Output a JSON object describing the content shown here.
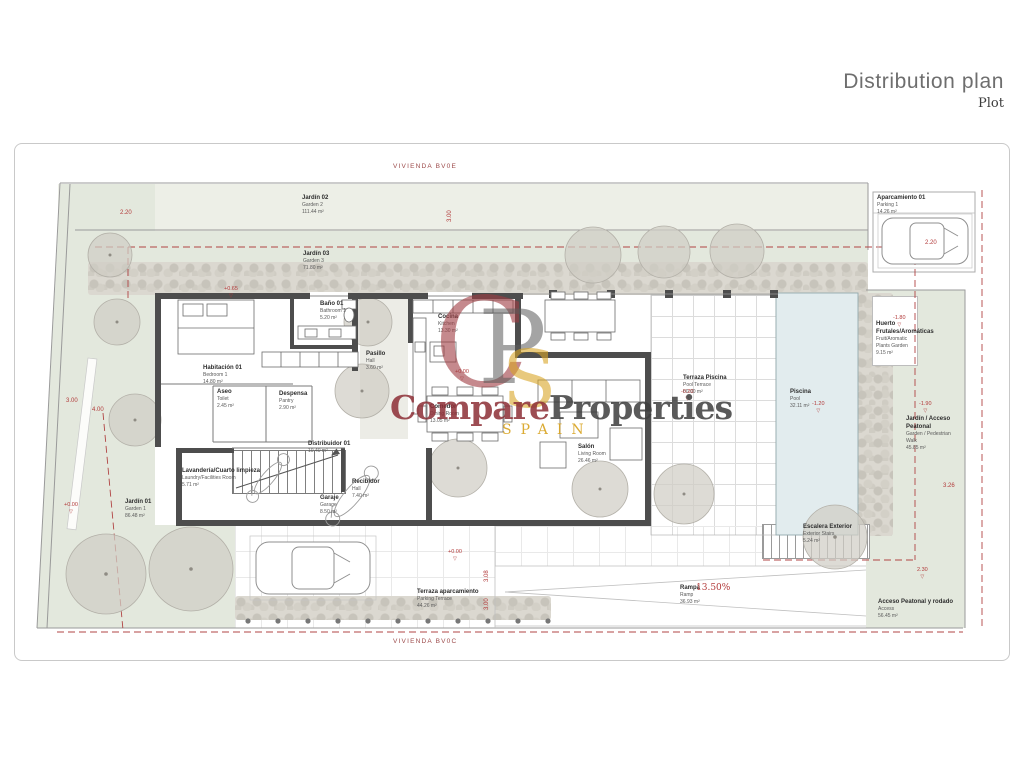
{
  "header": {
    "title": "Distribution plan",
    "subtitle": "Plot"
  },
  "plot_labels": {
    "top": "VIVIENDA BV0E",
    "bottom": "VIVIENDA BV0C"
  },
  "watermark": {
    "monogram": [
      "C",
      "P",
      "S"
    ],
    "word1": "Compare",
    "word2": "Properties",
    "country": "SPAIN",
    "colors": {
      "red": "#8d2e36",
      "gray": "#3e3e3e",
      "gold": "#d8a21e"
    }
  },
  "annotations": {
    "ramp_slope": "13.50%"
  },
  "room_labels": [
    {
      "id": "jardin-02",
      "title": "Jardín 02",
      "sub": "Garden 2",
      "area": "111.44 m²",
      "x": 302,
      "y": 194
    },
    {
      "id": "jardin-03",
      "title": "Jardín 03",
      "sub": "Garden 3",
      "area": "71.80 m²",
      "x": 303,
      "y": 250
    },
    {
      "id": "aparcamiento-01",
      "title": "Aparcamiento 01",
      "sub": "Parking 1",
      "area": "14.26 m²",
      "x": 877,
      "y": 194
    },
    {
      "id": "habitacion-01",
      "title": "Habitación 01",
      "sub": "Bedroom 1",
      "area": "14.80 m²",
      "x": 203,
      "y": 364
    },
    {
      "id": "bano-01",
      "title": "Baño 01",
      "sub": "Bathroom 1",
      "area": "5.20 m²",
      "x": 320,
      "y": 300
    },
    {
      "id": "pasillo",
      "title": "Pasillo",
      "sub": "Hall",
      "area": "3.60 m²",
      "x": 366,
      "y": 350
    },
    {
      "id": "cocina",
      "title": "Cocina",
      "sub": "Kitchen",
      "area": "13.30 m²",
      "x": 438,
      "y": 313
    },
    {
      "id": "comedor",
      "title": "Comedor",
      "sub": "Dining Room",
      "area": "13.05 m²",
      "x": 430,
      "y": 403
    },
    {
      "id": "salon",
      "title": "Salón",
      "sub": "Living Room",
      "area": "26.46 m²",
      "x": 578,
      "y": 443
    },
    {
      "id": "distribuidor-01",
      "title": "Distribuidor 01",
      "sub": "",
      "area": "10.40 m²",
      "x": 308,
      "y": 440
    },
    {
      "id": "recibidor",
      "title": "Recibidor",
      "sub": "Hall",
      "area": "7.40 m²",
      "x": 352,
      "y": 478
    },
    {
      "id": "garaje",
      "title": "Garaje",
      "sub": "Garage",
      "area": "8.50 m²",
      "x": 320,
      "y": 494
    },
    {
      "id": "lavanderia",
      "title": "Lavandería/Cuarto limpieza",
      "sub": "Laundry/Facilities Room",
      "area": "5.71 m²",
      "x": 182,
      "y": 467
    },
    {
      "id": "aseo",
      "title": "Aseo",
      "sub": "Toilet",
      "area": "2.45 m²",
      "x": 217,
      "y": 388
    },
    {
      "id": "despensa",
      "title": "Despensa",
      "sub": "Pantry",
      "area": "2.90 m²",
      "x": 279,
      "y": 390
    },
    {
      "id": "terraza-piscina",
      "title": "Terraza Piscina",
      "sub": "Pool Terrace",
      "area": "80.00 m²",
      "x": 683,
      "y": 374
    },
    {
      "id": "piscina",
      "title": "Piscina",
      "sub": "Pool",
      "area": "32.11 m²",
      "x": 790,
      "y": 388
    },
    {
      "id": "huerto",
      "title": "Huerto Frutales/Aromáticas",
      "sub": "Fruit/Aromatic Plants Garden",
      "area": "9.15 m²",
      "x": 876,
      "y": 320,
      "w": 38
    },
    {
      "id": "jardin-acceso",
      "title": "Jardín / Acceso Peatonal",
      "sub": "Garden / Pedestrian Walk",
      "area": "45.85 m²",
      "x": 906,
      "y": 415,
      "w": 48
    },
    {
      "id": "escalera-exterior",
      "title": "Escalera Exterior",
      "sub": "Exterior Stairs",
      "area": "5.24 m²",
      "x": 803,
      "y": 523
    },
    {
      "id": "acceso",
      "title": "Acceso Peatonal y rodado",
      "sub": "Access",
      "area": "56.45 m²",
      "x": 878,
      "y": 598
    },
    {
      "id": "rampa",
      "title": "Rampa",
      "sub": "Ramp",
      "area": "36.93 m²",
      "x": 680,
      "y": 584
    },
    {
      "id": "terraza-aparcamiento",
      "title": "Terraza aparcamiento",
      "sub": "Parking Terrace",
      "area": "44.26 m²",
      "x": 417,
      "y": 588
    },
    {
      "id": "jardin-01",
      "title": "Jardín 01",
      "sub": "Garden 1",
      "area": "86.48 m²",
      "x": 125,
      "y": 498
    }
  ],
  "level_markers": [
    {
      "v": "+0.00",
      "x": 455,
      "y": 370
    },
    {
      "v": "-0.20",
      "x": 681,
      "y": 390
    },
    {
      "v": "-1.20",
      "x": 812,
      "y": 402
    },
    {
      "v": "-1.80",
      "x": 893,
      "y": 316
    },
    {
      "v": "-1.90",
      "x": 919,
      "y": 402
    },
    {
      "v": "+0.00",
      "x": 448,
      "y": 550
    },
    {
      "v": "+0.00",
      "x": 64,
      "y": 503
    },
    {
      "v": "+0.65",
      "x": 224,
      "y": 287
    },
    {
      "v": "2.30",
      "x": 917,
      "y": 568
    }
  ],
  "dimensions": [
    {
      "v": "3.00",
      "x": 447,
      "y": 222,
      "rot": true
    },
    {
      "v": "2.20",
      "x": 925,
      "y": 240,
      "rot": false
    },
    {
      "v": "2.20",
      "x": 120,
      "y": 210,
      "rot": false
    },
    {
      "v": "3.00",
      "x": 66,
      "y": 398,
      "rot": false
    },
    {
      "v": "4.00",
      "x": 92,
      "y": 407,
      "rot": false
    },
    {
      "v": "3.08",
      "x": 484,
      "y": 582,
      "rot": true
    },
    {
      "v": "3.00",
      "x": 484,
      "y": 610,
      "rot": true
    },
    {
      "v": "3.26",
      "x": 943,
      "y": 483,
      "rot": false
    }
  ]
}
